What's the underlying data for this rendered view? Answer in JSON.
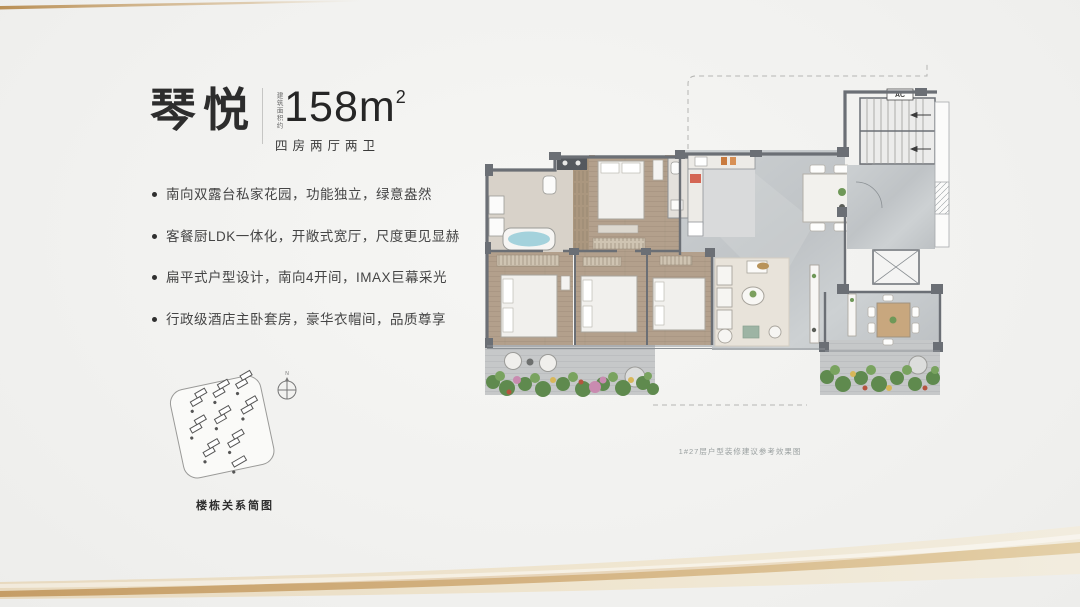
{
  "header": {
    "title": "琴悦",
    "area_note": "建筑面积约",
    "area_value": "158m",
    "area_sup": "2",
    "spec": "四房两厅两卫"
  },
  "features": [
    "南向双露台私家花园，功能独立，绿意盎然",
    "客餐厨LDK一体化，开敞式宽厅，尺度更见显赫",
    "扁平式户型设计，南向4开间，IMAX巨幕采光",
    "行政级酒店主卧套房，豪华衣帽间，品质尊享"
  ],
  "site_diagram": {
    "label": "楼栋关系简图",
    "compass": "N"
  },
  "floorplan": {
    "ac_label": "AC",
    "caption": "1#27层户型装修建议参考效果图"
  },
  "colors": {
    "accent_gold": "#c9a36e",
    "wall_gray": "#6b6f75",
    "wood_floor": "#b3a08c",
    "tile_gray": "#c6c9cb",
    "text_dark": "#2d2d2d",
    "plant_green": "#5f8a4e"
  }
}
